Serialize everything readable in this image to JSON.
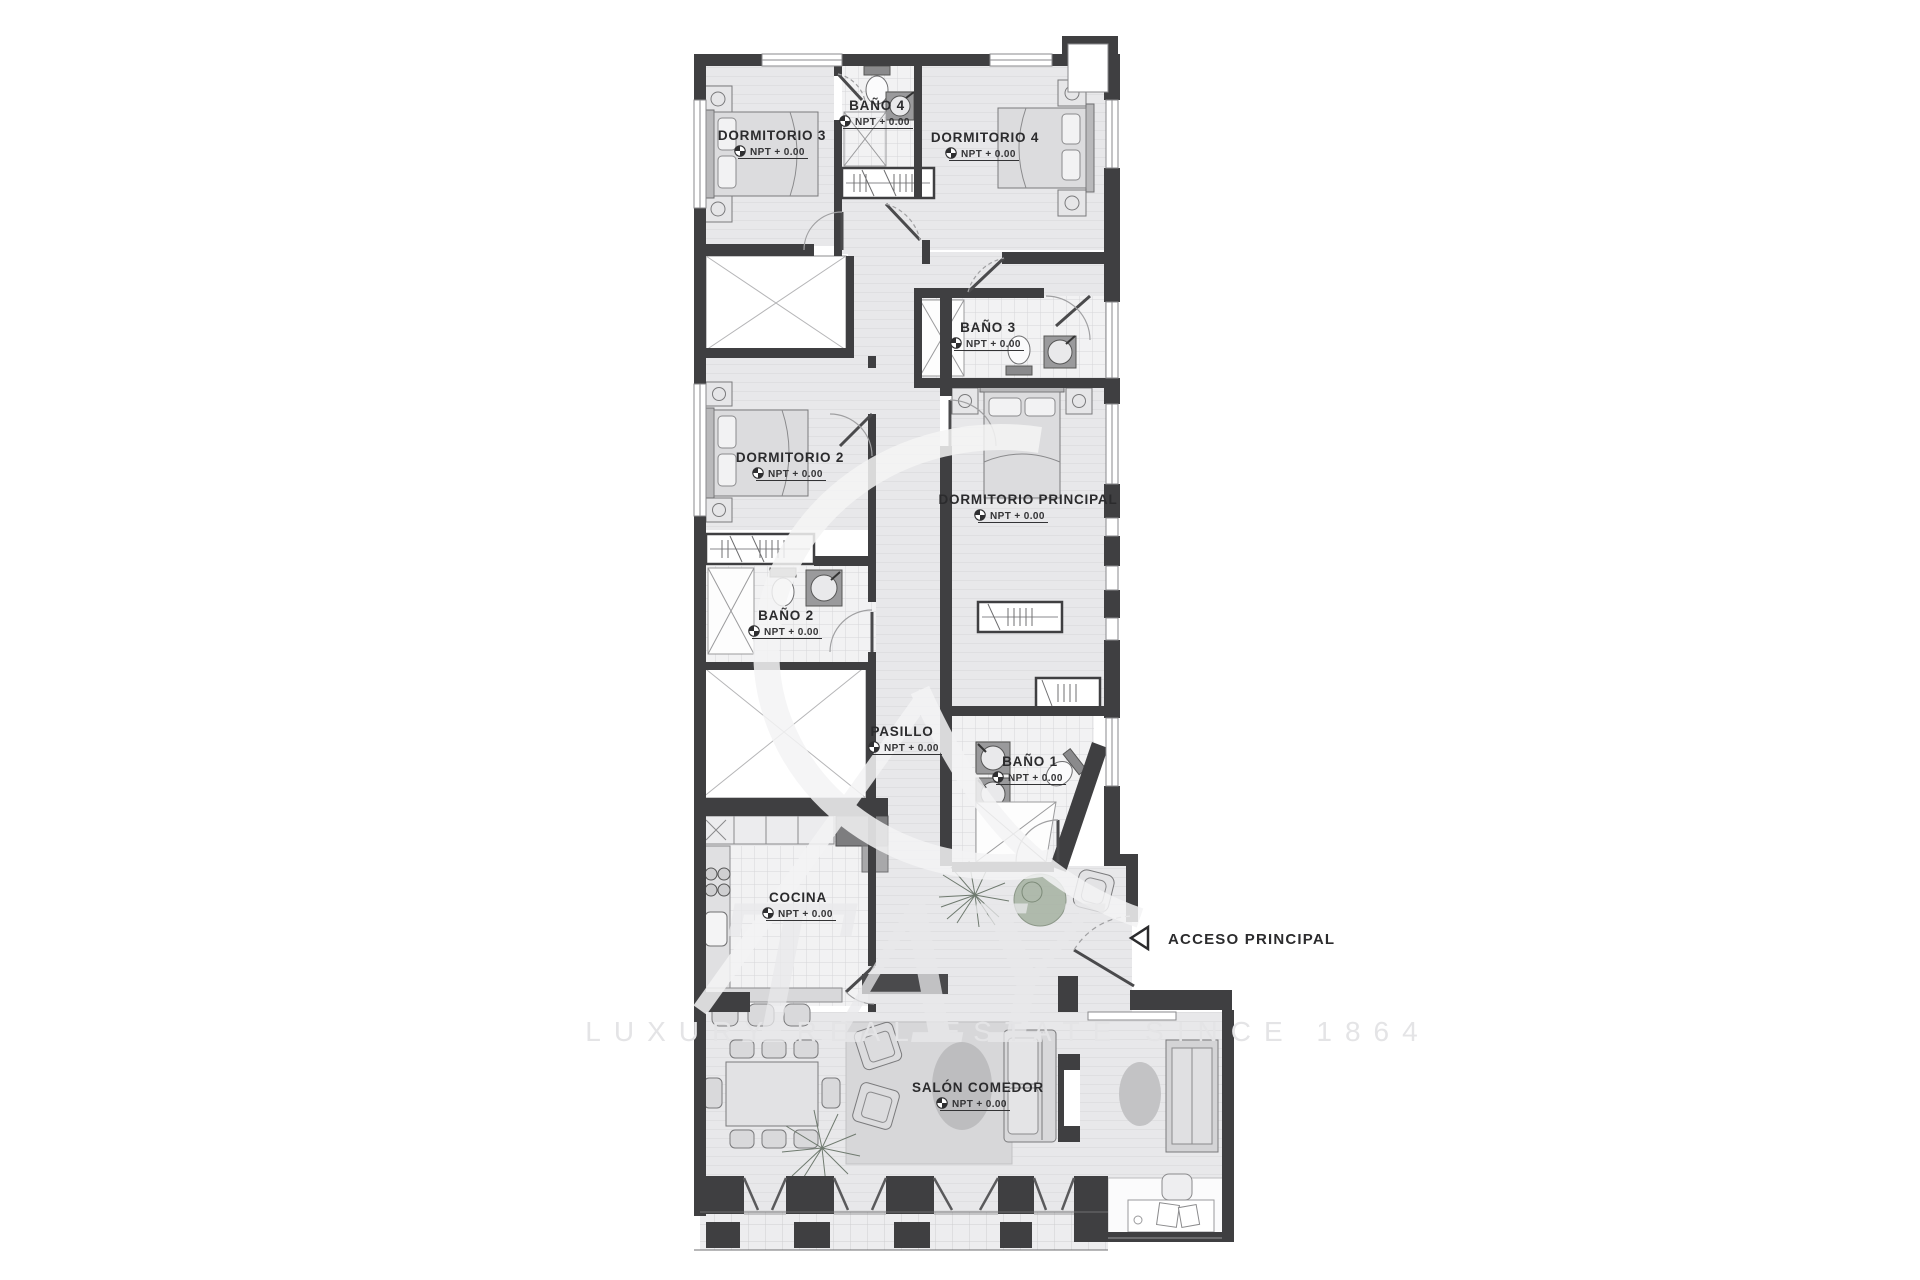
{
  "plan": {
    "npt_label": "NPT + 0.00",
    "entry_label": "ACCESO PRINCIPAL",
    "rooms": [
      {
        "id": "dormitorio-3",
        "label": "DORMITORIO 3"
      },
      {
        "id": "bano-4",
        "label": "BAÑO 4"
      },
      {
        "id": "dormitorio-4",
        "label": "DORMITORIO 4"
      },
      {
        "id": "bano-3",
        "label": "BAÑO 3"
      },
      {
        "id": "dormitorio-2",
        "label": "DORMITORIO 2"
      },
      {
        "id": "dormitorio-principal",
        "label": "DORMITORIO PRINCIPAL"
      },
      {
        "id": "bano-2",
        "label": "BAÑO 2"
      },
      {
        "id": "pasillo",
        "label": "PASILLO"
      },
      {
        "id": "bano-1",
        "label": "BAÑO 1"
      },
      {
        "id": "cocina",
        "label": "COCINA"
      },
      {
        "id": "salon-comedor",
        "label": "SALÓN COMEDOR"
      }
    ]
  },
  "watermark": {
    "monogram_letters": "TAY",
    "tagline": "LUXURY REAL ESTATE SINCE 1864"
  },
  "colors": {
    "wall": "#3f3f41",
    "floor": "#e7e7e9",
    "plant_green": "#9fae9b"
  }
}
